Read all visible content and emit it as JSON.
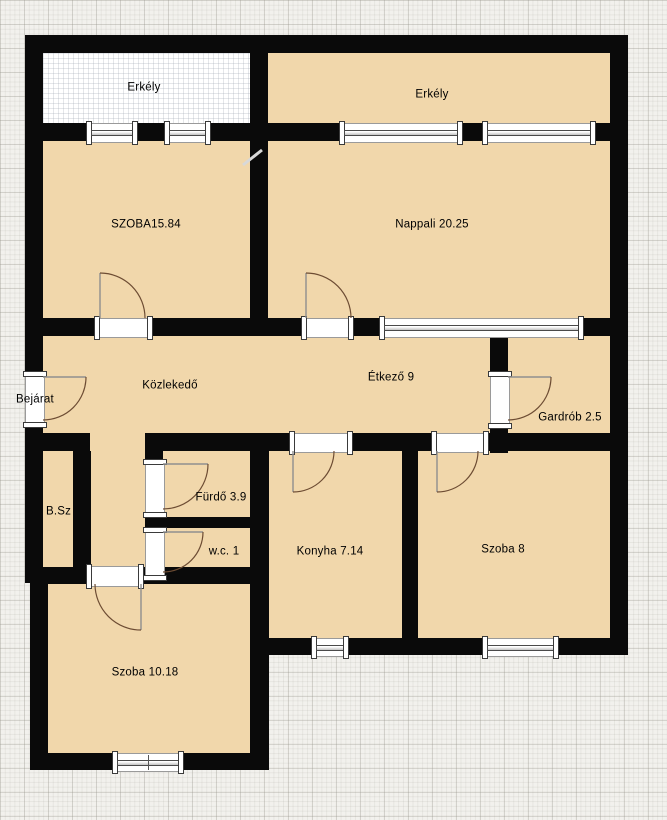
{
  "canvas": {
    "width": 667,
    "height": 820,
    "type": "apartment-floor-plan"
  },
  "labels": {
    "erkely_left": "Erkély",
    "erkely_right": "Erkély",
    "szoba_nagy": "SZOBA15.84",
    "nappali": "Nappali 20.25",
    "kozlekedo": "Közlekedő",
    "etkezo": "Étkező 9",
    "bejarat": "Bejárat",
    "gardrob": "Gardrób 2.5",
    "bsz": "B.Sz",
    "furdo": "Fürdő 3.9",
    "wc": "w.c. 1",
    "konyha": "Konyha 7.14",
    "szoba8": "Szoba 8",
    "szoba10": "Szoba 10.18"
  },
  "colors": {
    "wall": "#0a0a0a",
    "room_fill": "#f1d7ab",
    "balcony_fill": "#ffffff",
    "background": "#f2f1ed",
    "door_swing_arc": "#6d4c33",
    "door_leaf": "#8f8f8f",
    "label_text": "#000000"
  }
}
